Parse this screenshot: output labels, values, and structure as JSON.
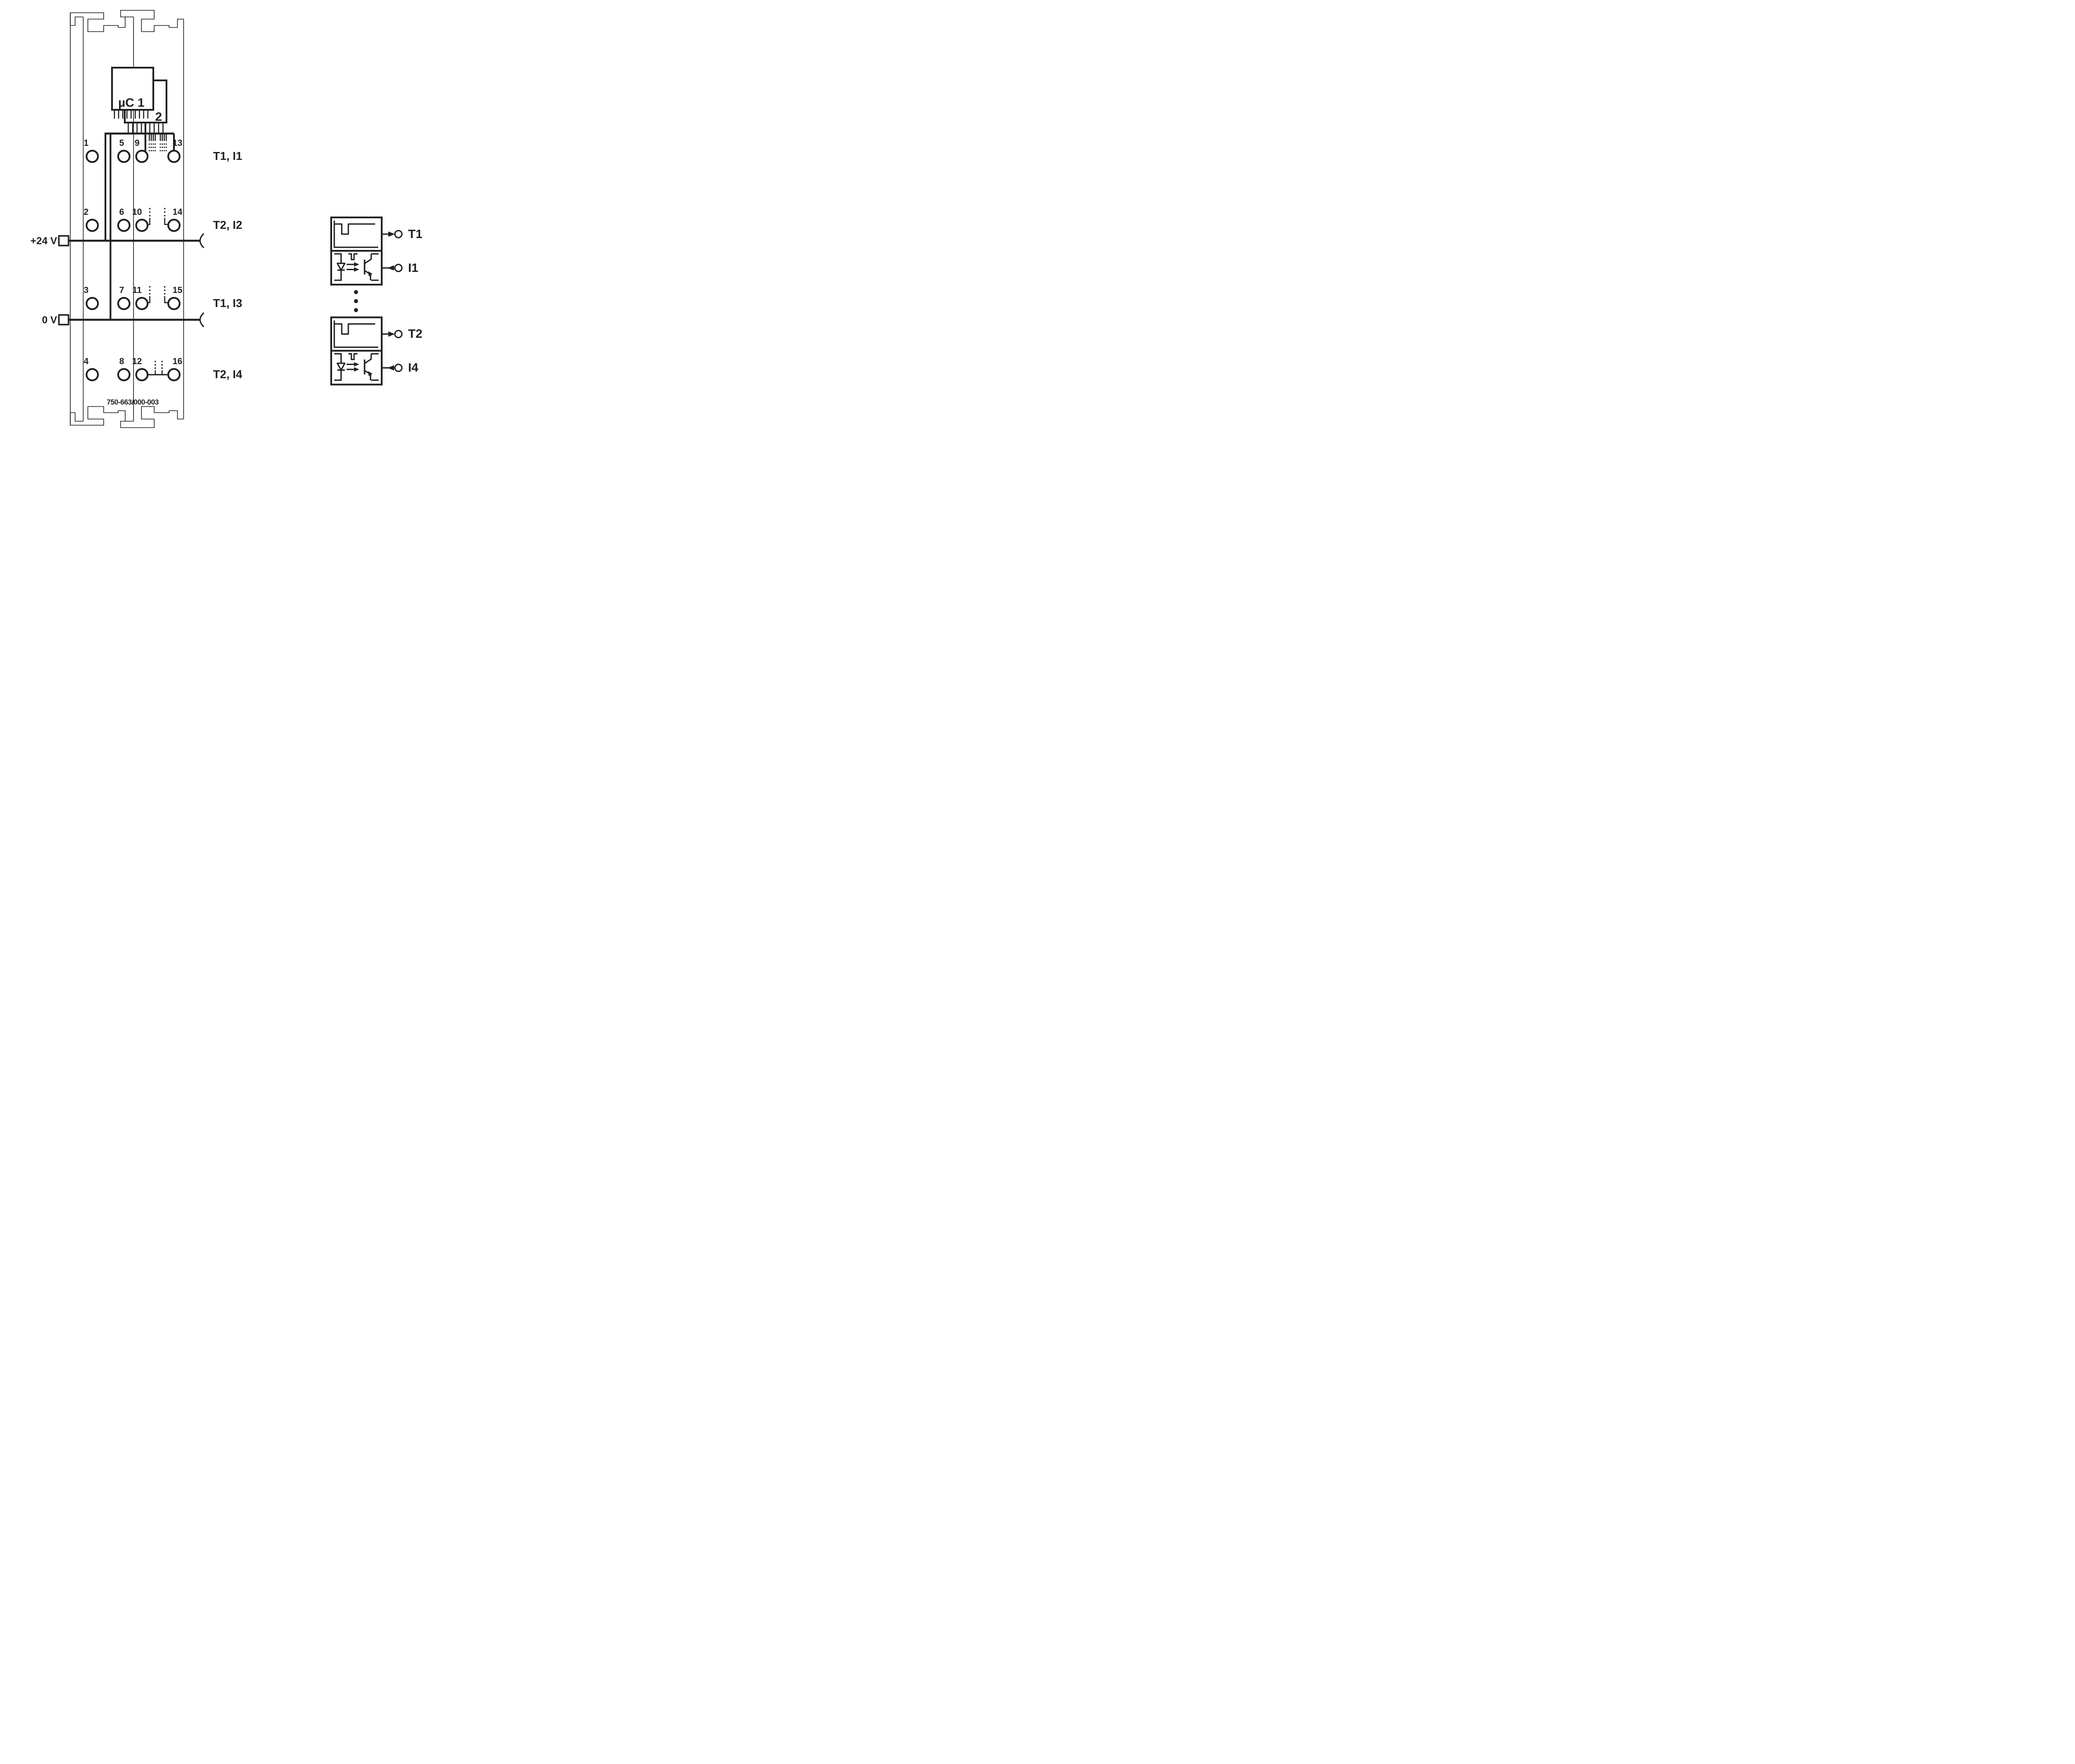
{
  "module": {
    "uc_label": "µC 1",
    "uc2_label": "2",
    "plus24_label": "+24 V",
    "zero_v_label": "0 V",
    "part_number": "750-663/000-003",
    "rows": [
      {
        "terminals": [
          "1",
          "5",
          "9",
          "13"
        ],
        "signal": "T1, I1"
      },
      {
        "terminals": [
          "2",
          "6",
          "10",
          "14"
        ],
        "signal": "T2, I2"
      },
      {
        "terminals": [
          "3",
          "7",
          "11",
          "15"
        ],
        "signal": "T1, I3"
      },
      {
        "terminals": [
          "4",
          "8",
          "12",
          "16"
        ],
        "signal": "T2, I4"
      }
    ]
  },
  "detail": {
    "channels": [
      {
        "output": "T1",
        "input": "I1"
      },
      {
        "output": "T2",
        "input": "I4"
      }
    ],
    "separator_dot_count": 3
  },
  "colors": {
    "ink": "#231f20",
    "background": "#ffffff"
  }
}
